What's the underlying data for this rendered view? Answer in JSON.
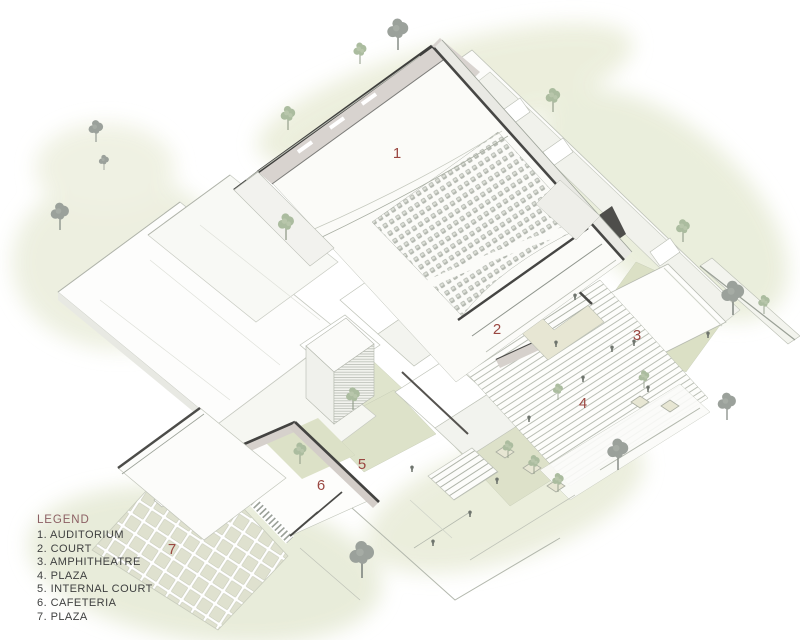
{
  "legend": {
    "title": "LEGEND",
    "items": [
      "1. AUDITORIUM",
      "2. COURT",
      "3. AMPHITHEATRE",
      "4. PLAZA",
      "5. INTERNAL COURT",
      "6. CAFETERIA",
      "7. PLAZA"
    ]
  },
  "markers": [
    {
      "id": "auditorium",
      "label": "1"
    },
    {
      "id": "court",
      "label": "2"
    },
    {
      "id": "amphitheatre",
      "label": "3"
    },
    {
      "id": "plaza-steps",
      "label": "4"
    },
    {
      "id": "internal-court",
      "label": "5"
    },
    {
      "id": "cafeteria",
      "label": "6"
    },
    {
      "id": "plaza-pavers",
      "label": "7"
    }
  ],
  "colors": {
    "marker_red": "#9a4741",
    "legend_title": "#8c6064",
    "legend_text": "#3f4040",
    "wash_green": "#e8ebda",
    "lawn_green": "#dbe0c5",
    "cut_wall_dark": "#434341",
    "wall_mauve": "#d7d2cd",
    "tree_gray": "#9ba19b",
    "tree_green": "#abbc9f",
    "paver_tile": "#dfe1cf"
  }
}
